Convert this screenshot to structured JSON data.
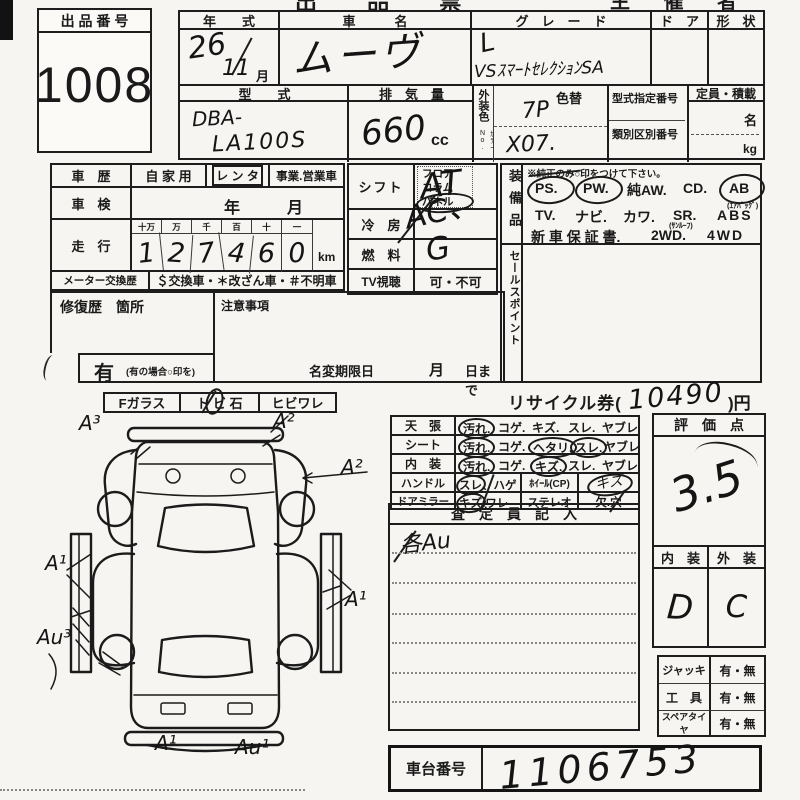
{
  "header": {
    "title_fragment": "出 品 票",
    "organizer_fragment": "主 催 者 用",
    "auction_no_label": "出 品 番 号",
    "auction_no": "1008"
  },
  "vehicle": {
    "year_label": "年　　式",
    "year_value": "26",
    "month_value": "11",
    "month_unit": "月",
    "name_label": "車　　　名",
    "name_value": "ムーヴ",
    "grade_label": "グ　レ　ー　ド",
    "grade_check": "L",
    "grade_value": "VSｽﾏｰﾄｾﾚｸｼｮﾝSA",
    "door_label": "ド　ア",
    "shape_label": "形　状",
    "model_label": "型　　式",
    "model_prefix": "DBA-",
    "model_code": "LA100S",
    "disp_label": "排　気　量",
    "disp_value": "660",
    "disp_unit": "cc",
    "color_label": "外装色",
    "color_no_label": "ｶﾗｰNo.",
    "color_change_label": "色替",
    "color_code": "7P",
    "color_no": "X07.",
    "type_no_label": "型式指定番号",
    "class_no_label": "類別区別番号",
    "capacity_label": "定員・積載",
    "persons_unit": "名",
    "weight_unit": "kg"
  },
  "history": {
    "label": "車　歴",
    "private": "自 家 用",
    "rental": "レ ン タ",
    "commercial": "事業.営業車",
    "inspection_label": "車　検",
    "inspection_year": "年",
    "inspection_month": "月",
    "mileage_label": "走　行",
    "digit_headers": [
      "十万",
      "万",
      "千",
      "百",
      "十",
      "一"
    ],
    "mileage_digits": [
      "1",
      "2",
      "7",
      "4",
      "6",
      "0"
    ],
    "mileage_unit": "km",
    "meter_label": "メーター交換歴",
    "meter_note": "＄交換車・＊改ざん車・＃不明車"
  },
  "repair": {
    "label": "修復歴　箇所",
    "notes_label": "注意事項",
    "yes": "有",
    "yes_note": "(有の場合○印を)",
    "rename_label": "名変期限日",
    "rename_month": "月",
    "rename_day": "日まで"
  },
  "spec": {
    "shift_label": "シフト",
    "shift_options": [
      "フロア",
      "コラム",
      "パネル"
    ],
    "shift_value": "AT",
    "ac_label": "冷　房",
    "ac_value": "AC、",
    "fuel_label": "燃　料",
    "fuel_value": "G",
    "tv_label": "TV視聴",
    "tv_options": "可・不可"
  },
  "equipment": {
    "label": "装備品",
    "note": "※純正のみ○印をつけて下さい。",
    "row1": [
      "PS.",
      "PW.",
      "純AW.",
      "CD.",
      "AB"
    ],
    "airbag_note": "(ｴｱﾊﾞｯｸﾞ)",
    "row2": [
      "TV.",
      "ナビ.",
      "カワ.",
      "SR.",
      "ABS"
    ],
    "sunroof_note": "(ｻﾝﾙｰﾌ)",
    "row3": [
      "新 車 保 証 書.",
      "2WD.",
      "4WD"
    ],
    "sales_label": "セールスポイント"
  },
  "glass": {
    "f_label": "Fガラス",
    "stone_label": "ト ビ 石",
    "crack_label": "ヒビワレ"
  },
  "diagram": {
    "annotations": [
      "A³",
      "A²",
      "A²",
      "A¹",
      "A¹",
      "Au³",
      "A¹",
      "Au¹"
    ]
  },
  "recycle": {
    "label": "リサイクル券(",
    "value": "10490",
    "suffix": ")円"
  },
  "condition": {
    "rows": [
      {
        "label": "天　張",
        "options": [
          "汚れ.",
          "コゲ.",
          "キズ.",
          "スレ.",
          "ヤブレ"
        ]
      },
      {
        "label": "シート",
        "options": [
          "汚れ.",
          "コゲ.",
          "ヘタリ.",
          "スレ.",
          "ヤブレ"
        ]
      },
      {
        "label": "内　装",
        "options": [
          "汚れ.",
          "コゲ.",
          "キズ.",
          "スレ.",
          "ヤブレ"
        ]
      },
      {
        "label": "ハンドル",
        "wear": "スレ、ハゲ",
        "wheel_label": "ﾎｲｰﾙ(CP)",
        "wheel_value": "キズ"
      },
      {
        "label": "ドアミラー",
        "damage": "キズ.ワレ",
        "stereo_label": "ステレオ",
        "missing": "欠.穴"
      }
    ]
  },
  "assessor": {
    "header": "査　定　員　記　入",
    "note": "各Au"
  },
  "score": {
    "header": "評　価　点",
    "value": "3.5",
    "interior_label": "内　装",
    "exterior_label": "外　装",
    "interior_value": "D",
    "exterior_value": "C"
  },
  "accessories": {
    "rows": [
      {
        "label": "ジャッキ",
        "options": "有・無"
      },
      {
        "label": "工　具",
        "options": "有・無"
      },
      {
        "label": "スペアタイヤ",
        "options": "有・無"
      }
    ]
  },
  "chassis": {
    "label": "車台番号",
    "value": "1106753"
  }
}
